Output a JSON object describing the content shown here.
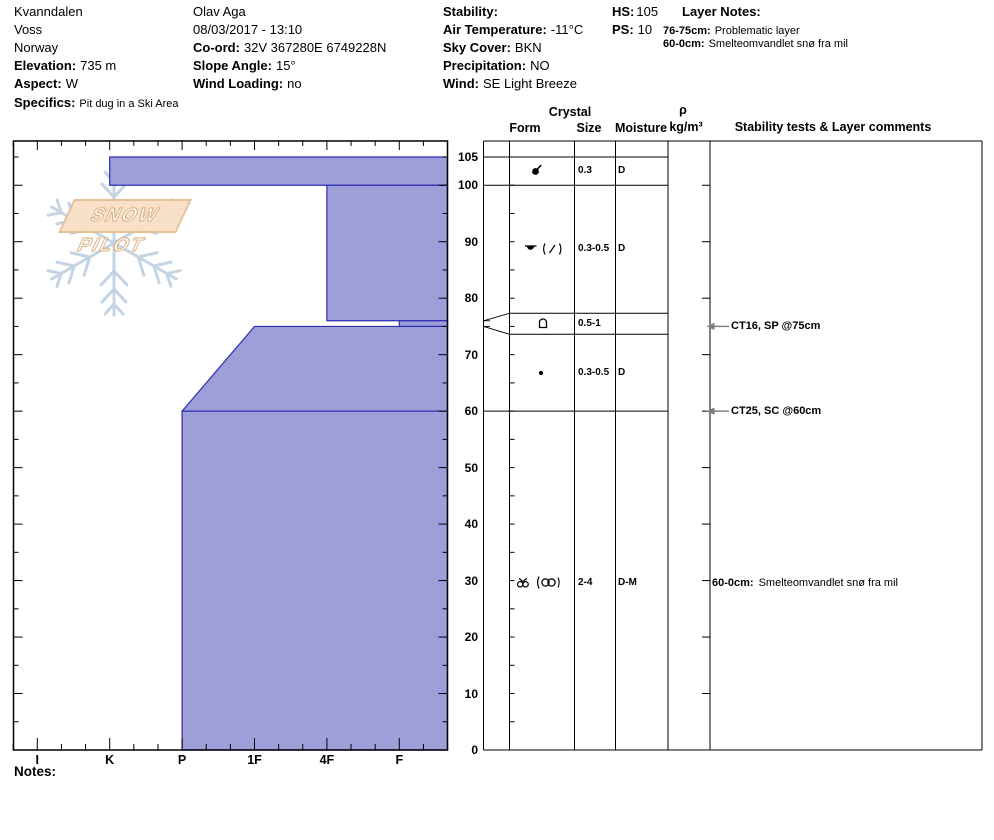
{
  "colors": {
    "layer_fill": "#9e9ed8",
    "layer_border": "#2e2eb4",
    "watermark_blue": "#c5d4e4",
    "banner_fill": "#f8e0c6",
    "banner_border": "#e4bd93",
    "arrow_gray": "#7d7d7d"
  },
  "header": {
    "location": {
      "name": "Kvanndalen",
      "region": "Voss",
      "country": "Norway",
      "elevation_label": "Elevation:",
      "elevation_value": "735 m",
      "aspect_label": "Aspect:",
      "aspect_value": "W",
      "specifics_label": "Specifics:",
      "specifics_value": "Pit dug in a Ski Area"
    },
    "observer": {
      "name": "Olav Aga",
      "datetime": "08/03/2017 - 13:10",
      "coord_label": "Co-ord:",
      "coord_value": "32V 367280E 6749228N",
      "slope_angle_label": "Slope Angle:",
      "slope_angle_value": "15°",
      "wind_loading_label": "Wind Loading:",
      "wind_loading_value": "no"
    },
    "conditions": {
      "stability_label": "Stability:",
      "stability_value": "",
      "air_temperature_label": "Air Temperature:",
      "air_temperature_value": "-11°C",
      "sky_cover_label": "Sky Cover:",
      "sky_cover_value": "BKN",
      "precipitation_label": "Precipitation:",
      "precipitation_value": "NO",
      "wind_label": "Wind:",
      "wind_value": "SE Light Breeze"
    },
    "totals": {
      "hs_label": "HS:",
      "hs_value": "105",
      "ps_label": "PS:",
      "ps_value": "10"
    },
    "layer_notes": {
      "title": "Layer Notes:",
      "entries": [
        {
          "range": "76-75cm:",
          "text": "Problematic layer"
        },
        {
          "range": "60-0cm:",
          "text": "Smelteomvandlet snø fra mil"
        }
      ]
    }
  },
  "watermark": {
    "text": "SNOW PILOT"
  },
  "table": {
    "headers": {
      "crystal": "Crystal",
      "form": "Form",
      "size": "Size",
      "moisture": "Moisture",
      "density_symbol": "ρ",
      "density_units": "kg/m³",
      "stability": "Stability tests & Layer comments"
    },
    "rows": [
      {
        "depth_range": "105-100",
        "form_icon": "dot-slash-grain-icon",
        "size": "0.3",
        "moisture": "D"
      },
      {
        "depth_range": "100-76",
        "form_icon": "dot-topbar-grain-icon",
        "form_secondary_icon": "paren-slash-grain-icon",
        "size": "0.3-0.5",
        "moisture": "D"
      },
      {
        "depth_range": "76-75",
        "form_icon": "arch-square-grain-icon",
        "size": "0.5-1",
        "moisture": ""
      },
      {
        "depth_range": "75-60",
        "form_icon": "small-dot-grain-icon",
        "size": "0.3-0.5",
        "moisture": "D"
      },
      {
        "depth_range": "60-0",
        "form_icon": "horned-double-circle-grain-icon",
        "form_secondary_icon": "paren-double-circle-grain-icon",
        "size": "2-4",
        "moisture": "D-M",
        "comment_label": "60-0cm:",
        "comment_text": "Smelteomvandlet snø fra mil"
      }
    ]
  },
  "stability_tests": [
    {
      "text": "CT16, SP @75cm",
      "depth_cm": 75
    },
    {
      "text": "CT25, SC @60cm",
      "depth_cm": 60
    }
  ],
  "footer": {
    "notes_label": "Notes:"
  },
  "chart_data": {
    "type": "area",
    "title": "Snow hardness profile",
    "xlabel": "Hand hardness",
    "ylabel": "Height above ground (cm)",
    "x_ticks": [
      "I",
      "K",
      "P",
      "1F",
      "4F",
      "F"
    ],
    "y_tick_labels": [
      105,
      100,
      90,
      80,
      70,
      60,
      50,
      40,
      30,
      20,
      10,
      0
    ],
    "ylim": [
      0,
      108
    ],
    "hs_cm": 105,
    "grid": false,
    "layers": [
      {
        "top_cm": 105,
        "bottom_cm": 100,
        "hardness_top": "K",
        "hardness_bottom": "K",
        "grain_size_mm": "0.3",
        "moisture": "D"
      },
      {
        "top_cm": 100,
        "bottom_cm": 76,
        "hardness_top": "4F",
        "hardness_bottom": "4F",
        "grain_size_mm": "0.3-0.5",
        "moisture": "D"
      },
      {
        "top_cm": 76,
        "bottom_cm": 75,
        "hardness_top": "F",
        "hardness_bottom": "F",
        "grain_size_mm": "0.5-1",
        "moisture": ""
      },
      {
        "top_cm": 75,
        "bottom_cm": 60,
        "hardness_top": "1F",
        "hardness_bottom": "P",
        "grain_size_mm": "0.3-0.5",
        "moisture": "D"
      },
      {
        "top_cm": 60,
        "bottom_cm": 0,
        "hardness_top": "P",
        "hardness_bottom": "P",
        "grain_size_mm": "2-4",
        "moisture": "D-M"
      }
    ],
    "tests": [
      {
        "text": "CT16, SP @75cm",
        "depth_cm": 75
      },
      {
        "text": "CT25, SC @60cm",
        "depth_cm": 60
      }
    ]
  }
}
